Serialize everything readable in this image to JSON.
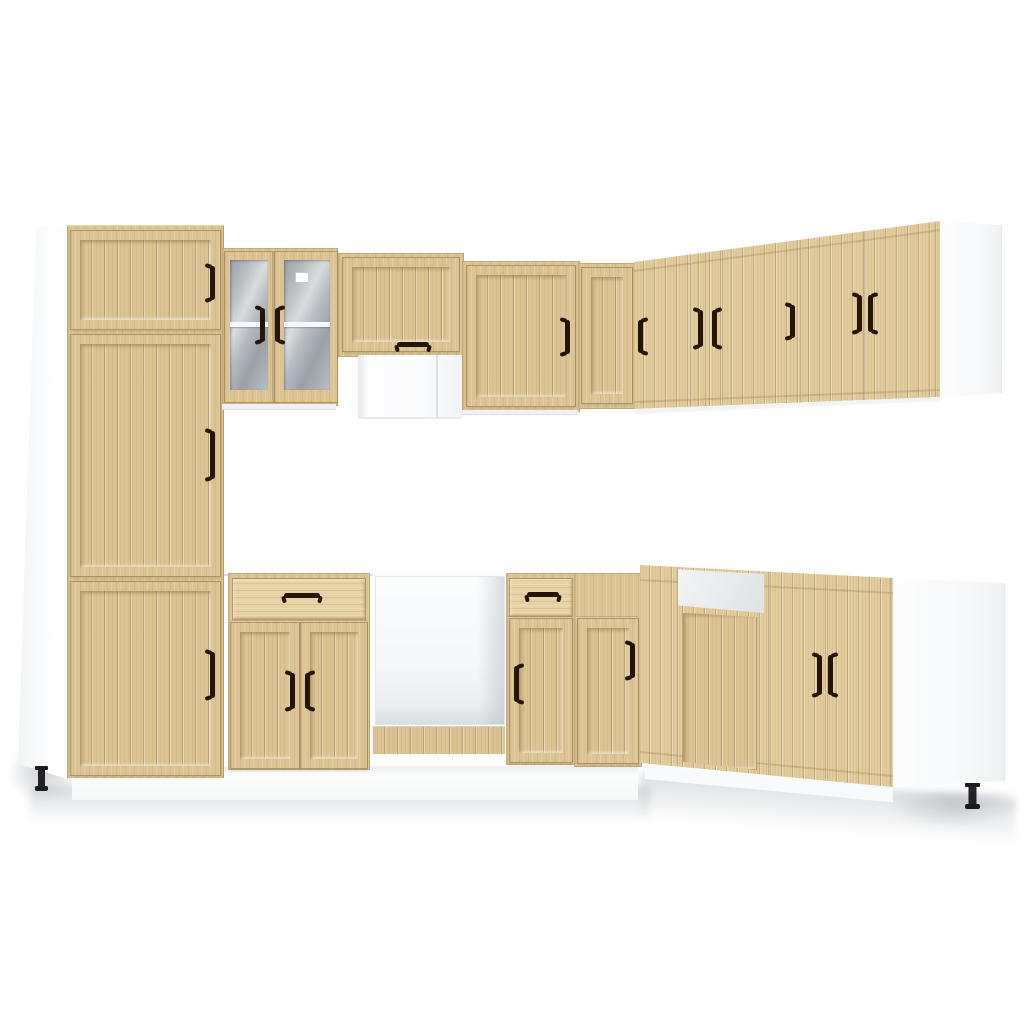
{
  "image": {
    "type": "product-photo",
    "subject": "L-shaped kitchen cabinet set, sonoma oak fronts with white carcass, floating on white background",
    "background": "#ffffff"
  },
  "colors": {
    "wood-base": "#dcc394",
    "wood-hi": "#e7d2a4",
    "wood-right": "#e2cb9c",
    "carcass-white": "#ffffff",
    "carcass-shade": "#eef1f3",
    "panel-edge": "#dde1e4",
    "glass-dark": "#9aa0a5",
    "glass-mid": "#b8bec3",
    "glass-hi": "#d9dde0",
    "shelf-white": "#f6f8f9",
    "handle-dark": "#241607",
    "chimney-white": "#fcfdfe",
    "plinth-white": "#fafbfc",
    "floor-shadow": "#9aa3ab"
  },
  "inventory": {
    "tall_pantry_cabinet": {
      "doors": 3,
      "handles": 3
    },
    "glass_wall_cabinet": {
      "doors": 2,
      "glass_panels": 2,
      "shelves": 1
    },
    "range_hood_cabinet": {
      "doors": 1,
      "chimneys": 1
    },
    "front_wall_cabinets": 2,
    "right_run_wall_doors": 6,
    "base_cabinets_with_drawer": 2,
    "oven_housings_open": 1,
    "corner_base_cabinets": 1,
    "sink_base_cabinets": 1,
    "right_run_base_doors": 3,
    "white_end_panels": 3,
    "visible_legs": 2
  }
}
